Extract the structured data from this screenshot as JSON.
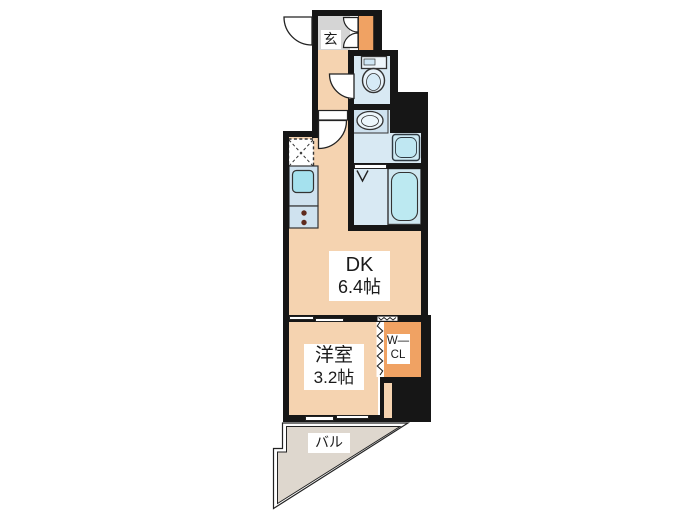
{
  "title": "apartment floor plan",
  "rooms": {
    "entrance": {
      "label": "玄"
    },
    "dining_kitchen": {
      "name": "DK",
      "area": "6.4帖"
    },
    "western_room": {
      "name": "洋室",
      "area": "3.2帖"
    },
    "walk_in_closet": {
      "line1": "W—",
      "line2": "CL"
    },
    "balcony": {
      "label": "バル"
    }
  },
  "fixtures": [
    "entry-door-swing",
    "shoe-cabinet",
    "toilet",
    "washbasin",
    "washing-machine-space",
    "bathtub",
    "shower-door-mark",
    "kitchen-sink",
    "gas-stove",
    "refrigerator-space",
    "sliding-doors",
    "accordion-closet-door",
    "balcony-windows"
  ],
  "colors": {
    "wall": "#161616",
    "room_peach": "#f5d3b0",
    "accent_orange": "#f0a263",
    "entrance_gray": "#d5d5d5",
    "wet_room_blue": "#d8e9f3",
    "fixture_blue": "#cfe2ef",
    "water_cyan": "#a5e1ee",
    "balcony_gray": "#ded7ce"
  }
}
